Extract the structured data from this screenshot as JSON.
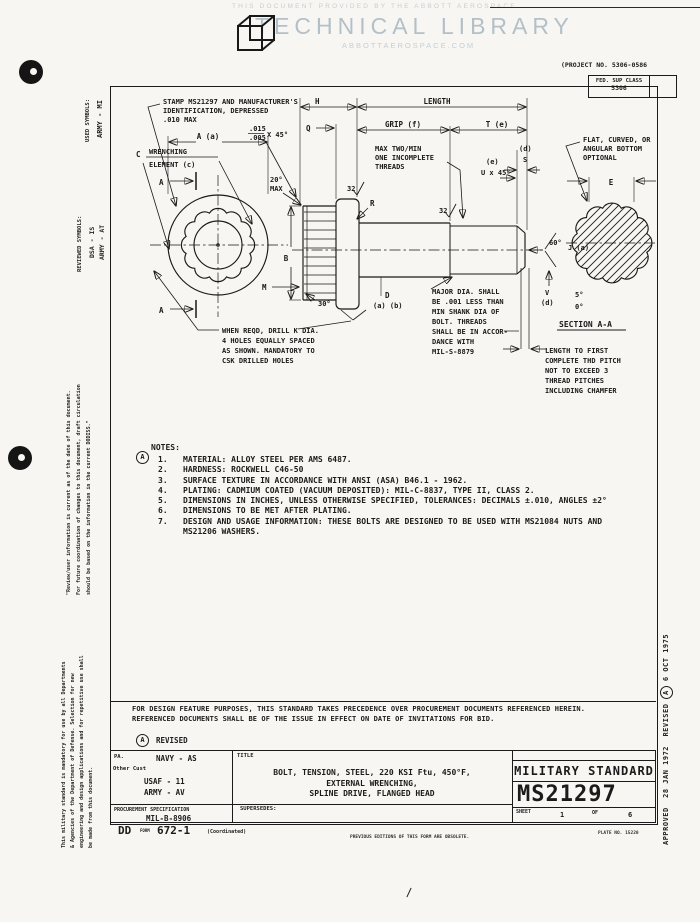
{
  "header": {
    "provided_by": "THIS DOCUMENT PROVIDED BY THE ABBOTT AEROSPACE",
    "library": "TECHNICAL LIBRARY",
    "site": "ABBOTTAEROSPACE.COM"
  },
  "top_right": {
    "project_no": "(PROJECT NO. 5306-0586",
    "fed_sup_class_label": "FED. SUP CLASS",
    "fed_sup_class": "5306"
  },
  "margins": {
    "left": {
      "used_symbols_label": "USED SYMBOLS:",
      "used_symbols_value": "ARMY - MI",
      "reviewed_symbols_label": "REVIEWED SYMBOLS:",
      "reviewed_value_1": "DSA - IS",
      "reviewed_value_2": "ARMY - AT",
      "review_note_1": "\"Review/user information is current as of the date of this document.",
      "review_note_2": "For future coordination of changes to this document, draft circulation",
      "review_note_3": "should be based on the information in the current DODISS.\"",
      "mandatory_note_1": "This military standard is mandatory for use by all Departments",
      "mandatory_note_2": "& Agencies of the Department of Defense.  Selection for new",
      "mandatory_note_3": "engineering and design applications and for repetitive use shall",
      "mandatory_note_4": "be made from this document."
    },
    "right": {
      "approved_label": "APPROVED",
      "approved_date": "28 JAN 1972",
      "revised_label": "REVISED",
      "revision_letter": "A",
      "revised_date": "6 OCT 1975"
    }
  },
  "drawing": {
    "stamp_callout": [
      "STAMP MS21297 AND MANUFACTURER'S",
      "IDENTIFICATION, DEPRESSED",
      ".010 MAX"
    ],
    "chamfer_tol": [
      ".015",
      ".005",
      "X 45°"
    ],
    "wrenching": [
      "C",
      "WRENCHING",
      "ELEMENT (c)"
    ],
    "dim_a": "A (a)",
    "section_arrow": "A",
    "angle20": [
      "20°",
      "MAX"
    ],
    "dim_h": "H",
    "dim_q": "Q",
    "dim_length": "LENGTH",
    "dim_grip": "GRIP (f)",
    "dim_t": "T (e)",
    "incomplete_threads": [
      "MAX TWO/MIN",
      "ONE INCOMPLETE",
      "THREADS"
    ],
    "dim_s": [
      "(d)",
      "S"
    ],
    "dim_u": [
      "(e)",
      "U x 45°"
    ],
    "dim_b": "B",
    "dim_m": "M",
    "angle30": "30°",
    "dim_r": "R",
    "finish_32": "32",
    "dim_d": [
      "D",
      "(a) (b)"
    ],
    "drill_callout": [
      "WHEN REQD, DRILL K DIA.",
      "4 HOLES EQUALLY SPACED",
      "AS SHOWN.  MANDATORY TO",
      "CSK DRILLED HOLES"
    ],
    "major_dia_callout": [
      "MAJOR DIA. SHALL",
      "BE .001 LESS THAN",
      "MIN SHANK DIA OF",
      "BOLT. THREADS",
      "SHALL BE IN ACCOR-",
      "DANCE WITH",
      "MIL-S-8879"
    ],
    "thd_pitch_callout": [
      "LENGTH TO FIRST",
      "COMPLETE THD PITCH",
      "NOT TO EXCEED 3",
      "THREAD PITCHES",
      "INCLUDING CHAMFER"
    ],
    "flat_callout": [
      "FLAT, CURVED, OR",
      "ANGULAR BOTTOM",
      "OPTIONAL"
    ],
    "dim_e": "E",
    "angle60": "60°",
    "dim_j": "J (a)",
    "dim_v": [
      "V",
      "(d)"
    ],
    "angle_chamfer": [
      "5°",
      "0°"
    ],
    "section_label": "SECTION A-A"
  },
  "notes": {
    "revision_letter": "A",
    "title": "NOTES:",
    "items": [
      {
        "n": "1.",
        "t": "MATERIAL:  ALLOY STEEL PER AMS 6487."
      },
      {
        "n": "2.",
        "t": "HARDNESS:  ROCKWELL C46-50"
      },
      {
        "n": "3.",
        "t": "SURFACE TEXTURE IN ACCORDANCE WITH ANSI (ASA) B46.1 - 1962."
      },
      {
        "n": "4.",
        "t": "PLATING:  CADMIUM COATED (VACUUM DEPOSITED):  MIL-C-8837, TYPE II, CLASS 2."
      },
      {
        "n": "5.",
        "t": "DIMENSIONS IN INCHES, UNLESS OTHERWISE SPECIFIED, TOLERANCES:  DECIMALS ±.010, ANGLES ±2°"
      },
      {
        "n": "6.",
        "t": "DIMENSIONS TO BE MET AFTER PLATING."
      },
      {
        "n": "7.",
        "t": "DESIGN AND USAGE INFORMATION:  THESE BOLTS ARE DESIGNED TO BE USED WITH MS21084 NUTS AND"
      }
    ],
    "item7_cont": "MS21206 WASHERS."
  },
  "footer": {
    "precedence_1": "FOR DESIGN FEATURE PURPOSES, THIS STANDARD TAKES PRECEDENCE OVER PROCUREMENT DOCUMENTS REFERENCED HEREIN.",
    "precedence_2": "REFERENCED DOCUMENTS SHALL BE OF THE ISSUE IN EFFECT ON DATE OF INVITATIONS FOR BID.",
    "revision_letter": "A",
    "revised_label": "REVISED",
    "title_block": {
      "pa_label": "PA.",
      "pa_value": "NAVY - AS",
      "other_cust_label": "Other Cust",
      "custodian_1": "USAF - 11",
      "custodian_2": "ARMY - AV",
      "proc_spec_label": "PROCUREMENT SPECIFICATION",
      "proc_spec_value": "MIL-B-8906",
      "title_label": "TITLE",
      "title_line_1": "BOLT, TENSION, STEEL, 220 KSI Ftu, 450°F,",
      "title_line_2": "EXTERNAL WRENCHING,",
      "title_line_3": "SPLINE DRIVE, FLANGED HEAD",
      "supersedes_label": "SUPERSEDES:",
      "standard_type": "MILITARY STANDARD",
      "standard_number": "MS21297",
      "sheet_label": "SHEET",
      "sheet_value": "1",
      "of_label": "OF",
      "sheet_total": "6",
      "plate_no": "PLATE NO. 15220",
      "dd_label": "DD",
      "dd_form_small": "FORM",
      "dd_form_number": "672-1",
      "dd_coordinated": "(Coordinated)",
      "previous_editions": "PREVIOUS EDITIONS OF THIS FORM ARE OBSOLETE."
    }
  }
}
